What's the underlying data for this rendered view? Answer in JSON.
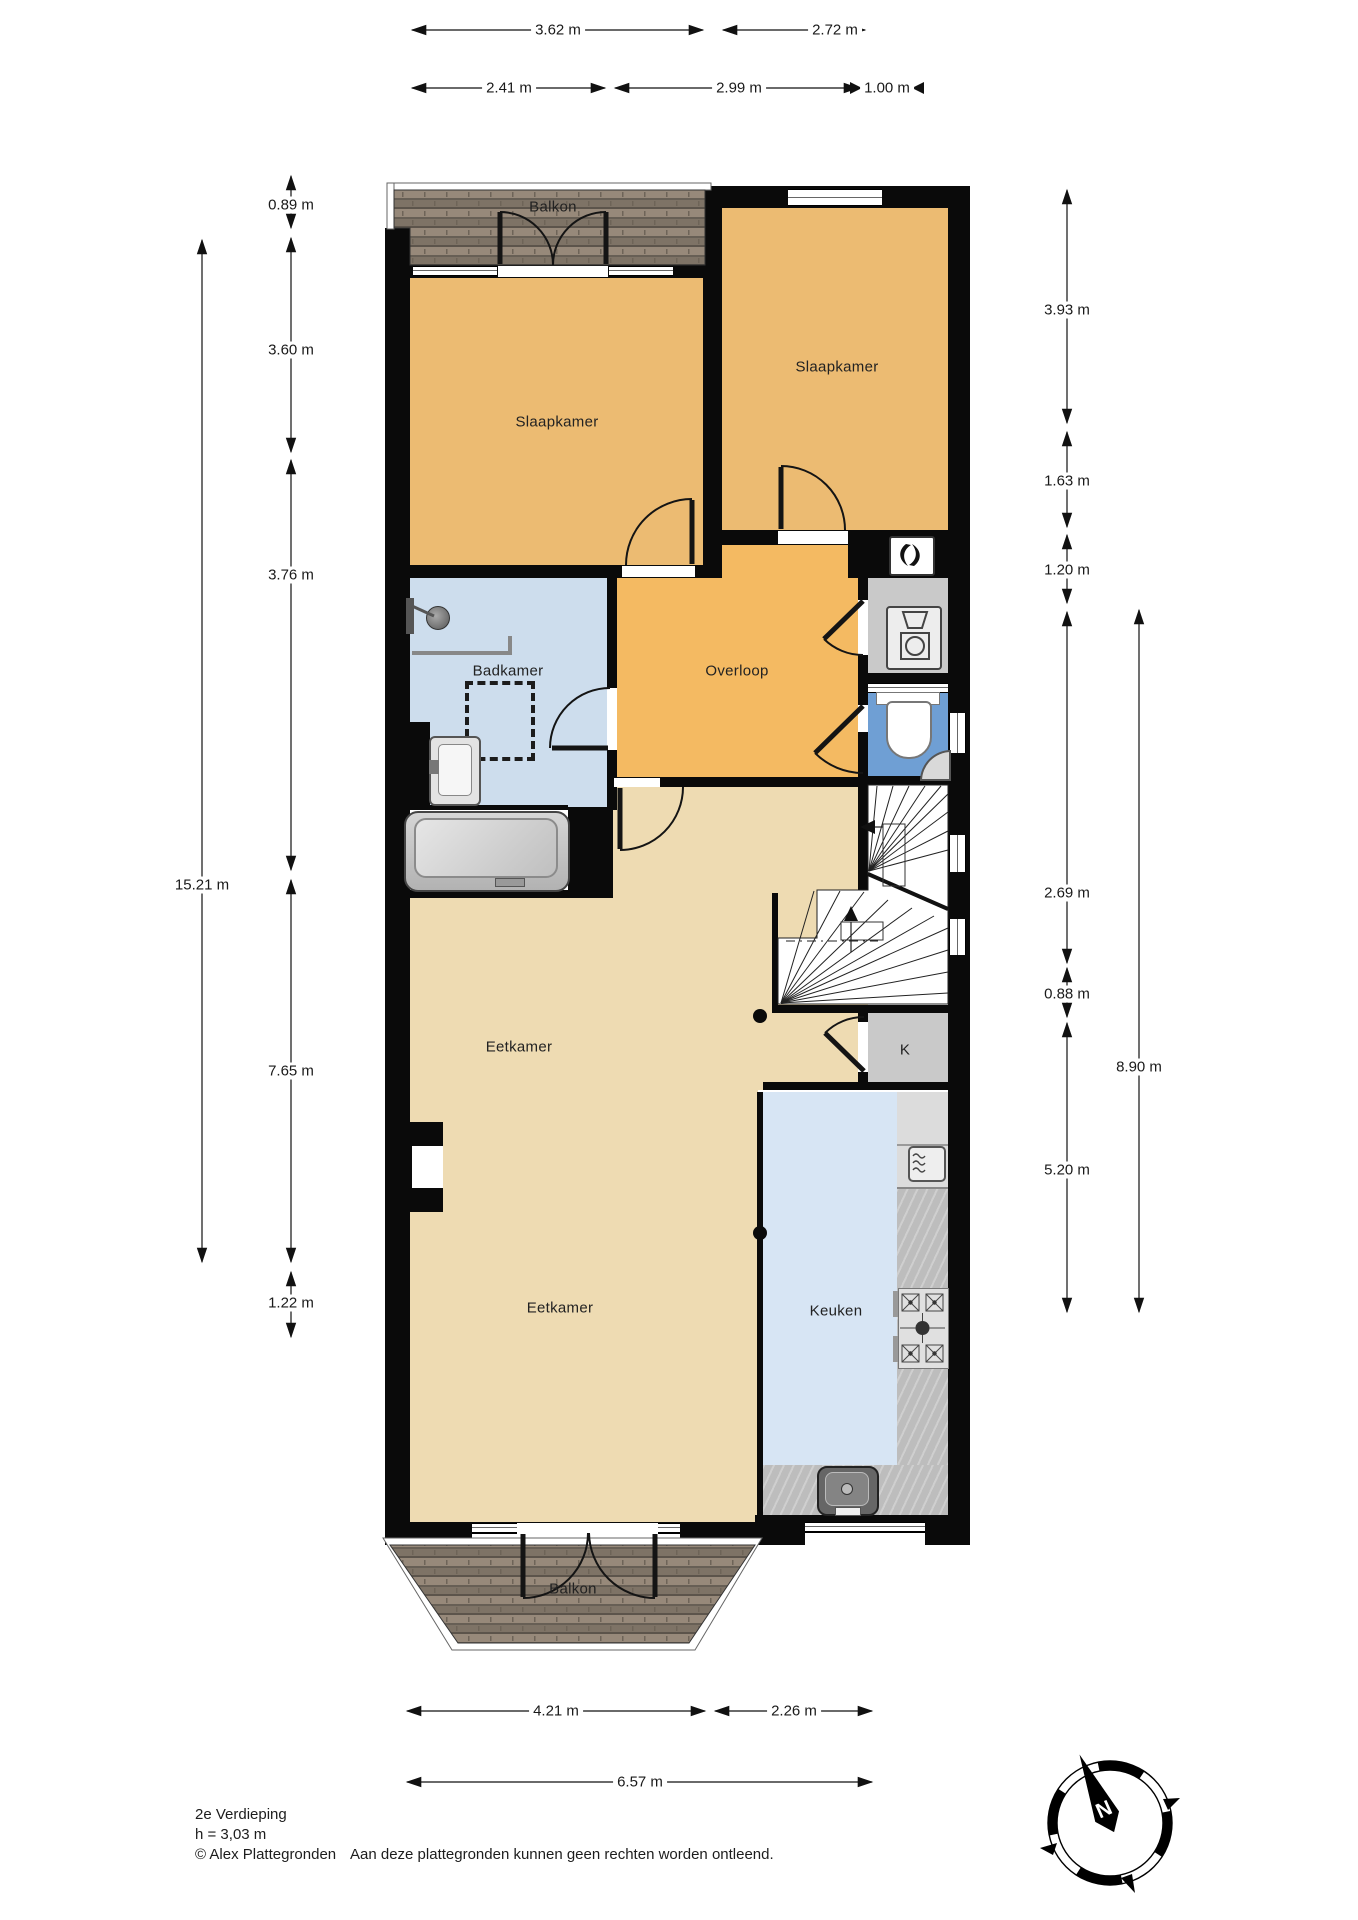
{
  "meta": {
    "floor_title": "2e Verdieping",
    "ceiling_height": "h = 3,03 m",
    "copyright": "© Alex Plattegronden",
    "disclaimer": "Aan deze plattegronden kunnen geen rechten worden ontleend."
  },
  "compass": {
    "north": "N"
  },
  "rooms": {
    "balkon_top": "Balkon",
    "slaapkamer_left": "Slaapkamer",
    "slaapkamer_right": "Slaapkamer",
    "badkamer": "Badkamer",
    "overloop": "Overloop",
    "eetkamer_upper": "Eetkamer",
    "eetkamer_lower": "Eetkamer",
    "keuken": "Keuken",
    "kast": "K",
    "balkon_bottom": "Balkon"
  },
  "dimensions": {
    "top": [
      "3.62 m",
      "2.72 m",
      "2.41 m",
      "2.99 m",
      "1.00 m"
    ],
    "left": [
      "0.89 m",
      "3.60 m",
      "3.76 m",
      "15.21 m",
      "7.65 m",
      "1.22 m"
    ],
    "right": [
      "3.93 m",
      "1.63 m",
      "1.20 m",
      "2.69 m",
      "0.88 m",
      "8.90 m",
      "5.20 m"
    ],
    "bottom": [
      "4.21 m",
      "2.26 m",
      "6.57 m"
    ]
  },
  "colors": {
    "bedroom": "#ecbb72",
    "landing": "#f4ba62",
    "dining": "#eedbb2",
    "bathroom": "#cddded",
    "toilet": "#6f9fd4",
    "kitchen_floor": "#d7e5f4",
    "closet": "#c9c9c9",
    "wall": "#0a0a0a"
  }
}
